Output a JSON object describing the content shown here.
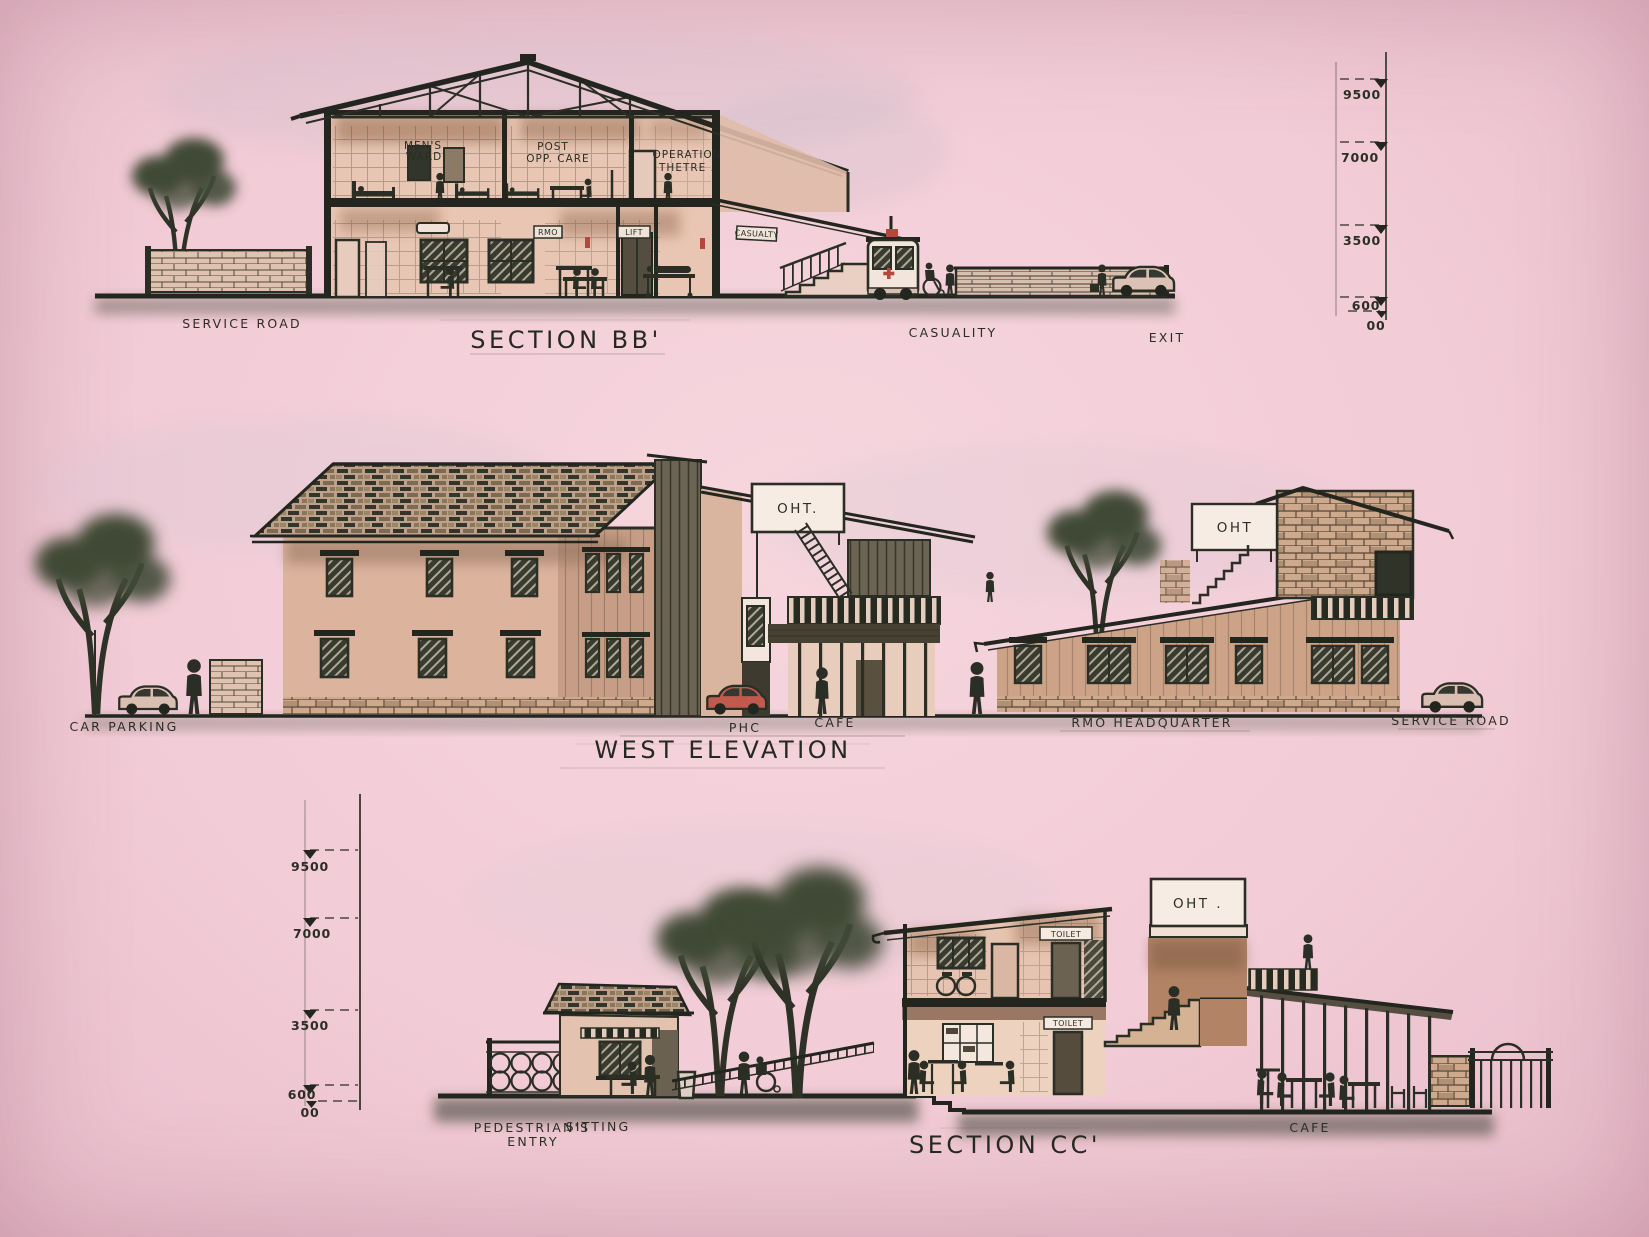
{
  "colors": {
    "paper": "#f2ccd7",
    "ink": "#2b2e25",
    "wall_warm": "#dcb49e",
    "shade_green": "#3e4637",
    "red_accent": "#b5473c"
  },
  "section_bb": {
    "title": "SECTION BB'",
    "labels": {
      "mens_ward_1": "MEN'S",
      "mens_ward_2": "WARD",
      "post_op_1": "POST",
      "post_op_2": "OPP. CARE",
      "operation_1": "OPERATION",
      "operation_2": "THETRE .",
      "rmo_sign": "RMO",
      "lift_sign": "LIFT",
      "casualty_sign": "CASUALTY",
      "service_road": "SERVICE ROAD",
      "casuality": "CASUALITY",
      "exit": "EXIT"
    },
    "scale": [
      "9500",
      "7000",
      "3500",
      "600",
      "00"
    ]
  },
  "west_elevation": {
    "title": "WEST ELEVATION",
    "labels": {
      "car_parking": "CAR PARKING",
      "phc": "PHC",
      "cafe": "CAFE",
      "rmo_headquarter": "RMO HEADQUARTER",
      "service_road": "SERVICE ROAD",
      "oht_center": "OHT.",
      "oht_right": "OHT"
    }
  },
  "section_cc": {
    "title": "SECTION CC'",
    "labels": {
      "pedestrians_entry_1": "PEDESTRIAN'S",
      "pedestrians_entry_2": "ENTRY",
      "sitting": "SITTING",
      "toilet_upper": "TOILET",
      "toilet_lower": "TOILET",
      "oht": "OHT .",
      "cafe": "CAFE"
    },
    "scale": [
      "9500",
      "7000",
      "3500",
      "600",
      "00"
    ]
  }
}
